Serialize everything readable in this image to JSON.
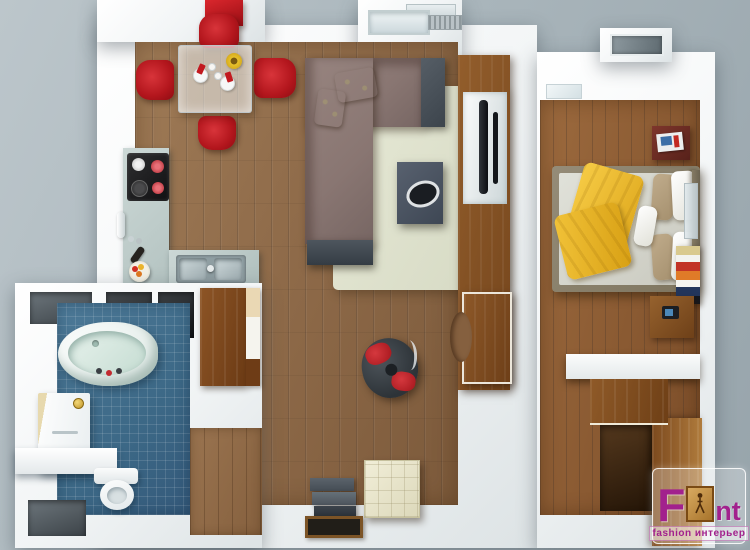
{
  "meta": {
    "description": "3D rendered top-down floor plan of a one-bedroom apartment",
    "rooms": [
      "kitchen-dining",
      "living-room",
      "bedroom",
      "bathroom",
      "entry-hallway"
    ]
  },
  "watermark": {
    "brand_prefix": "F",
    "brand_suffix": "nt",
    "tagline": "fashion интерьер"
  },
  "palette": {
    "background_gray": "#aab6bc",
    "wall_white": "#f4f6f7",
    "living_floor_wood": "#8c6847",
    "bedroom_floor_wood": "#8a5a32",
    "bathroom_tile_blue": "#3c6886",
    "accent_red": "#c2191f",
    "sofa_mauve": "#897672",
    "rug_cream": "#e0e3cf",
    "blanket_yellow": "#f2c13e",
    "kitchen_counter_gray": "#bac9c8",
    "furniture_wood": "#8a5426",
    "logo_magenta": "#a2218d"
  },
  "objects": [
    "dining-table-with-four-red-chairs",
    "red-wall-cabinet",
    "kitchen-cooktop",
    "kitchen-double-sink",
    "fruit-bowl",
    "wine-bottle",
    "l-shaped-sectional-sofa",
    "area-rug",
    "coffee-table",
    "tv-wall-unit",
    "swivel-egg-chair",
    "ottoman-pouf",
    "step-shelf",
    "floor-tray",
    "double-bed-with-yellow-blanket",
    "nightstands",
    "book-stack-shelf",
    "desk-with-white-top",
    "wardrobe",
    "bathtub",
    "shower-unit",
    "toilet",
    "hallway-closet",
    "windows"
  ]
}
